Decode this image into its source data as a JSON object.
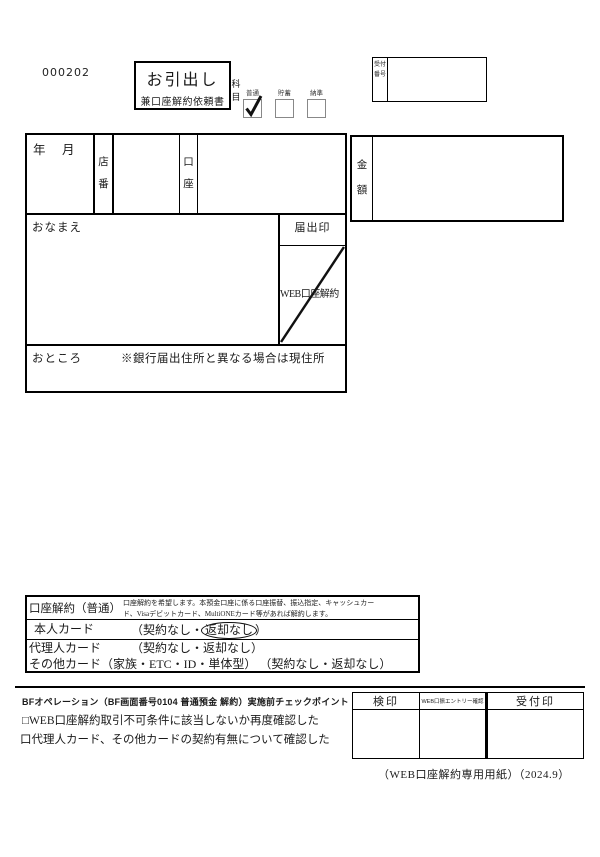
{
  "header": {
    "form_code": "000202",
    "title_main": "お引出し",
    "title_sub": "兼口座解約依頼書",
    "subject_label": "科目",
    "subject_options": [
      {
        "label": "普通",
        "checked": true
      },
      {
        "label": "貯蓄",
        "checked": false
      },
      {
        "label": "納準",
        "checked": false
      }
    ],
    "reception_label": "受付番号"
  },
  "main_form": {
    "date_label": "年　月　日",
    "branch_label": "店番",
    "account_label": "口座",
    "name_label": "おなまえ",
    "seal_label": "届出印",
    "web_cancel_label": "WEB口座解約",
    "address_label": "おところ",
    "address_note": "※銀行届出住所と異なる場合は現住所",
    "amount_label": "金額"
  },
  "cancel_section": {
    "title": "口座解約（普通）",
    "description_line1": "口座解約を希望します。本預金口座に係る口座振替、振込指定、キャッシュカー",
    "description_line2": "ド、Visaデビットカード、MultiONEカード等があれば解約します。",
    "rows": [
      {
        "label": "本人カード",
        "option_prefix": "（契約なし・",
        "circled": "返却なし",
        "option_suffix": "）"
      },
      {
        "label": "代理人カード",
        "options": "（契約なし・返却なし）"
      },
      {
        "label": "その他カード（家族・ETC・ID・単体型）",
        "options": "（契約なし・返却なし）"
      }
    ]
  },
  "check_section": {
    "title": "BFオペレーション（BF画面番号0104 普通預金 解約）実施前チェックポイント",
    "items": [
      "□WEB口座解約取引不可条件に該当しないか再度確認した",
      "口代理人カード、その他カードの契約有無について確認した"
    ]
  },
  "stamp_table": {
    "col1": "検印",
    "col2": "WEB口振エントリー確認",
    "col3": "受付印"
  },
  "footer_note": "（WEB口座解約専用用紙）（2024.9）",
  "colors": {
    "ink": "#1a1a1a",
    "border": "#000000",
    "background": "#ffffff"
  }
}
